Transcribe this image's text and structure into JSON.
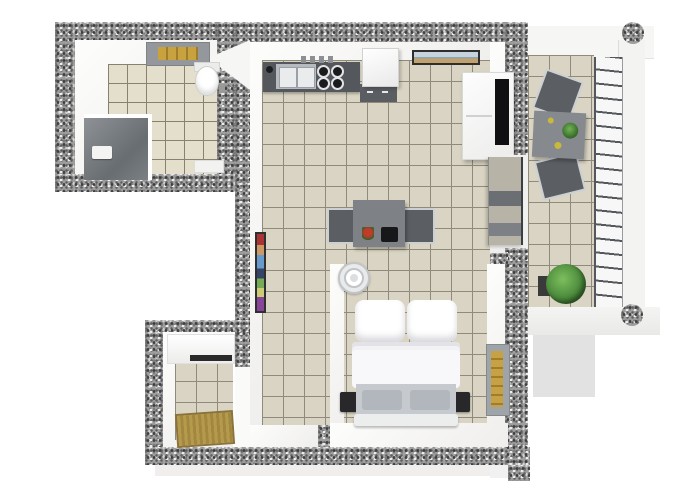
{
  "scene": {
    "type": "3d-floor-plan-top-view",
    "description": "Rendered top-down 3D floor plan of a one-bedroom apartment with balcony",
    "background_color": "#ffffff"
  },
  "palette": {
    "wall_granite": "#9e9e9e",
    "wall_speckle_dark": "#3f3f3f",
    "wall_speckle_light": "#efefef",
    "inner_wall_white": "#f6f6f4",
    "tile_floor": "#d9d4c3",
    "tile_grout": "#8f8a7b",
    "bathroom_tile": "#e4dfcc",
    "counter_gray": "#54585d",
    "table_gray": "#7e8286",
    "chair_dark": "#5b5f63",
    "bed_white": "#fafafb",
    "bed_base_gray": "#c6cacf",
    "nightstand_black": "#28282a",
    "doormat_gold": "#b3964c",
    "skylight_gold": "#c7a23e",
    "window_gold": "#bd9a42",
    "plant_green": "#4c8a3c",
    "glass_gray": "#8a9095",
    "shadow_gray": "#e2e2e2"
  },
  "rooms": [
    {
      "name": "bathroom",
      "position": "top-left",
      "furniture": [
        "shower-cabin",
        "shower-head",
        "toilet",
        "toilet-brush",
        "ceiling-skylight",
        "bath-mat"
      ]
    },
    {
      "name": "kitchen-living-room",
      "position": "center",
      "furniture": [
        "kitchen-counter",
        "double-sink",
        "faucet",
        "cooktop-4-burners",
        "counter-jars",
        "fridge",
        "kitchen-base-cabinet",
        "wall-picture-landscape",
        "dining-table",
        "dining-chair-left",
        "dining-chair-right",
        "flower-on-table",
        "laptop-on-table",
        "tall-painting",
        "wardrobe-with-mirror"
      ]
    },
    {
      "name": "bedroom",
      "position": "bottom-center",
      "furniture": [
        "double-bed",
        "pillow-left",
        "pillow-right",
        "duvet",
        "nightstand-left",
        "nightstand-right",
        "ceiling-lamp",
        "gold-wall-window"
      ]
    },
    {
      "name": "entry-hall",
      "position": "bottom-left",
      "furniture": [
        "sideboard-cabinet",
        "doormat"
      ]
    },
    {
      "name": "balcony",
      "position": "right",
      "furniture": [
        "bistro-table",
        "table-plant",
        "table-plates",
        "balcony-chair-top",
        "balcony-chair-bottom",
        "potted-plant",
        "sliding-glass-door",
        "railing",
        "round-column-top",
        "round-column-bottom"
      ]
    }
  ]
}
